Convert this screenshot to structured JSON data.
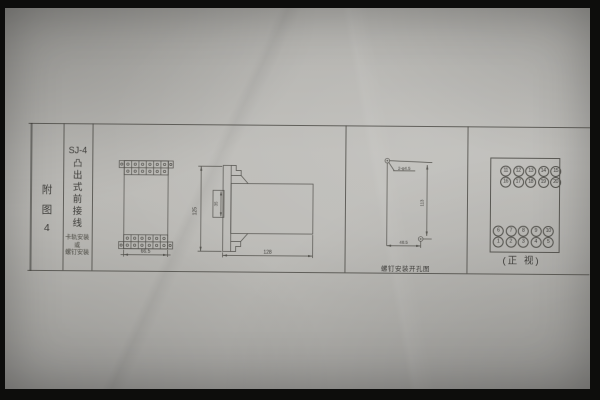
{
  "colors": {
    "paper": "#b8b7b2",
    "line": "#53524d",
    "text": "#3c3b38",
    "frame": "#0d0d0c"
  },
  "margin_label": {
    "chars": [
      "附",
      "图",
      "4"
    ]
  },
  "title_block": {
    "model": "SJ-4",
    "symbol": "凸",
    "title_chars": [
      "出",
      "式",
      "前",
      "接",
      "线"
    ],
    "mounting": [
      "卡轨安装",
      "或",
      "螺钉安装"
    ]
  },
  "plan_view": {
    "width_dim": "66.5",
    "terminal_rows": 2,
    "terminal_cols": 6
  },
  "side_view": {
    "height_dim": "125",
    "depth_dim": "128",
    "window_dim": "35"
  },
  "drill_view": {
    "hole_label": "2-φ4.5",
    "height_dim": "113",
    "width_dim": "48.5",
    "caption": "螺钉安装开孔图"
  },
  "panel_view": {
    "rows": [
      [
        "11",
        "12",
        "13",
        "14",
        "15"
      ],
      [
        "16",
        "17",
        "18",
        "19",
        "20"
      ],
      [
        "6",
        "7",
        "8",
        "9",
        "10"
      ],
      [
        "1",
        "2",
        "3",
        "4",
        "5"
      ]
    ],
    "caption": "(正 视)"
  }
}
